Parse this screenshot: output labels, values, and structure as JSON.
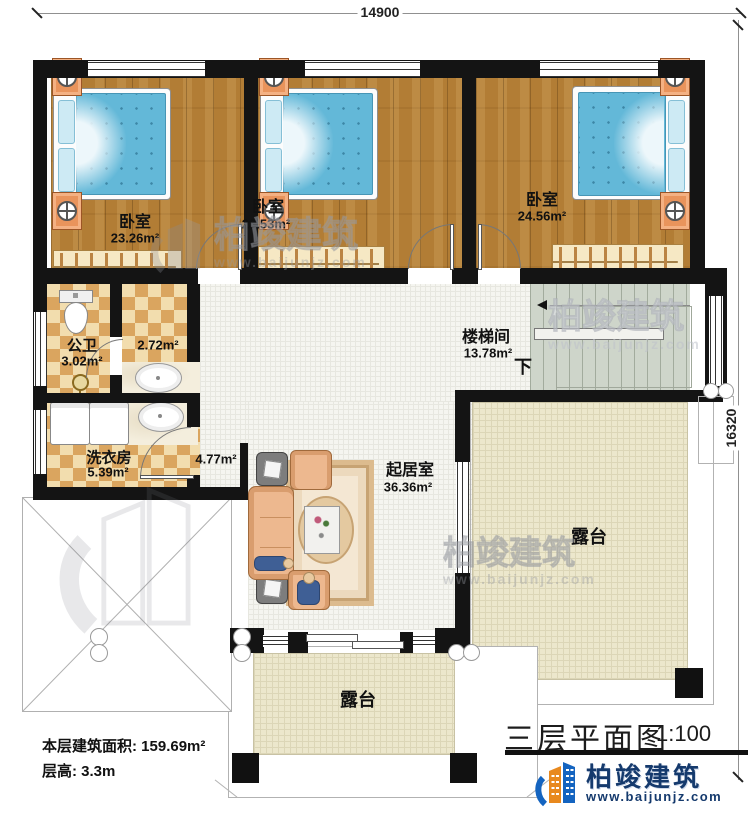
{
  "dimensions": {
    "top": "14900",
    "right": "16320"
  },
  "rooms": {
    "bedroom1": {
      "name": "卧室",
      "area": "23.26m²"
    },
    "bedroom2": {
      "name": "卧室",
      "area": "23.53m²"
    },
    "bedroom3": {
      "name": "卧室",
      "area": "24.56m²"
    },
    "bathroom": {
      "name": "公卫",
      "area": "3.02m²"
    },
    "vanity": {
      "area": "2.72m²"
    },
    "laundry": {
      "name": "洗衣房",
      "area": "5.39m²"
    },
    "hall": {
      "area": "4.77m²"
    },
    "stairwell": {
      "name": "楼梯间",
      "area": "13.78m²",
      "down": "下"
    },
    "living": {
      "name": "起居室",
      "area": "36.36m²"
    },
    "terrace_right": {
      "name": "露台"
    },
    "terrace_bottom": {
      "name": "露台"
    }
  },
  "info": {
    "area": "本层建筑面积: 159.69m²",
    "height": "层高: 3.3m"
  },
  "title_block": {
    "title": "三层平面图",
    "scale": "1:100",
    "brand": "柏竣建筑",
    "website": "www.baijunjz.com"
  },
  "watermark": {
    "brand": "柏竣建筑",
    "website": "www.baijunjz.com"
  },
  "colors": {
    "wall": "#141414",
    "wood_floor": "#b27d35",
    "bed_blue": "#63b8d8",
    "checker_tan": "#daa55f",
    "terrace_beige": "#ece7cc",
    "stairs_gray": "#ced5ca",
    "brand_navy": "#153a6d",
    "brand_blue": "#1464c0",
    "brand_orange": "#e8891e"
  }
}
